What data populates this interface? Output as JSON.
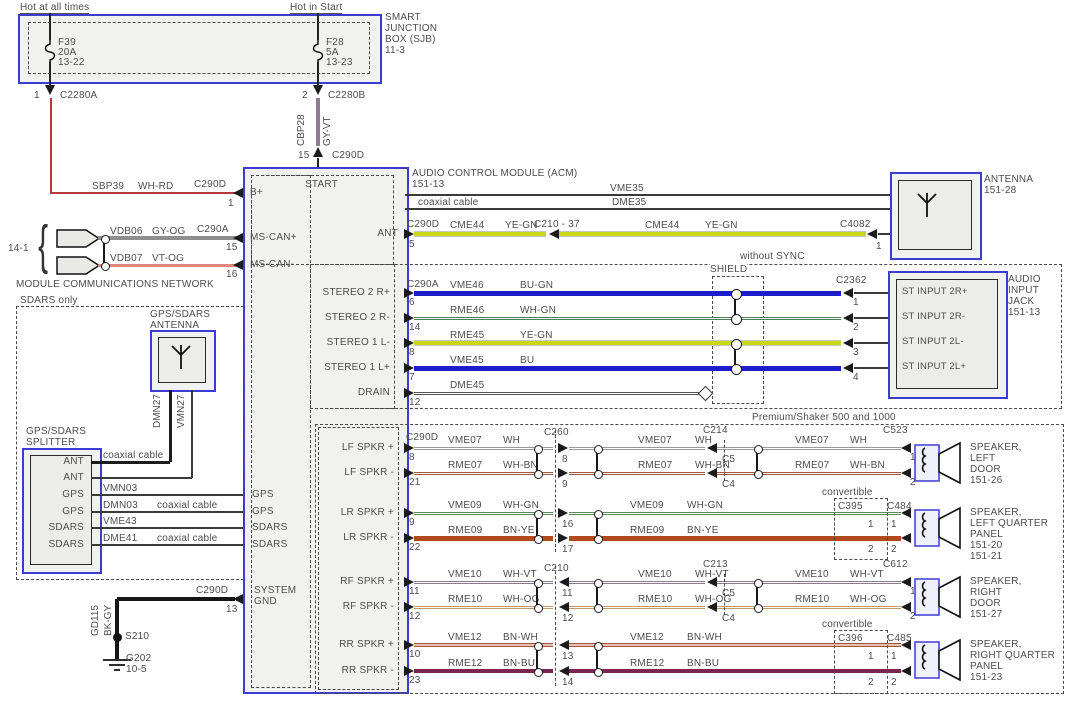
{
  "palette": {
    "box_blue": "#3c3cd0",
    "box_fill": "#f1f1ef",
    "text": "#4d4d4d",
    "wire_blue": "#1c1ecb",
    "wire_yegn": "#c9d816",
    "wire_whgn": "#4f7d55",
    "wire_wh": "#999999",
    "wire_whbn": "#a3543c",
    "wire_whgn2": "#5d8b5d",
    "wire_bnye": "#b2491c",
    "wire_whvt": "#8a7a92",
    "wire_whog": "#c09a6a",
    "wire_bnwh": "#a3543c",
    "wire_bnwh_center": "#e8c0b0",
    "wire_bnbu": "#7c2450",
    "wire_drain": "#555555",
    "wire_red": "#b93a3a",
    "wire_pink": "#e2857f",
    "wire_gyog": "#8f8f8f",
    "wire_gyvt": "#8d7b90",
    "wire_black": "#1c1c1c"
  },
  "power": {
    "hot_left": "Hot at all times",
    "hot_right": "Hot in Start",
    "sjb_lines": [
      "SMART",
      "JUNCTION",
      "BOX (SJB)",
      "11-3"
    ],
    "fuses": [
      {
        "name": "F39",
        "rating": "20A",
        "ref": "13-22",
        "pin": "1",
        "conn": "C2280A"
      },
      {
        "name": "F28",
        "rating": "5A",
        "ref": "13-23",
        "pin": "2",
        "conn": "C2280B"
      }
    ],
    "feed_right": {
      "circuit": "CBP28",
      "color": "GY-VT",
      "pin": "15",
      "conn": "C290D"
    },
    "bplus": {
      "circuit": "SBP39",
      "color": "WH-RD",
      "conn": "C290D",
      "pin": "1",
      "acm_label": "B+"
    }
  },
  "acm": {
    "title": "AUDIO CONTROL MODULE (ACM)",
    "ref": "151-13",
    "start": "START",
    "ant": "ANT",
    "system_gnd": [
      "SYSTEM",
      "GND"
    ],
    "gps_pins": [
      "GPS",
      "GPS",
      "SDARS",
      "SDARS"
    ]
  },
  "comms": {
    "bracket_ref": "14-1",
    "network_label": "MODULE COMMUNICATIONS NETWORK",
    "rows": [
      {
        "circuit": "VDB06",
        "color": "GY-OG",
        "conn": "C290A",
        "pin": "15",
        "acm_label": "MS-CAN+"
      },
      {
        "circuit": "VDB07",
        "color": "VT-OG",
        "conn": "",
        "pin": "16",
        "acm_label": "MS-CAN-"
      }
    ]
  },
  "sdars": {
    "section_label": "SDARS only",
    "antenna_label": [
      "GPS/SDARS",
      "ANTENNA"
    ],
    "splitter_label": [
      "GPS/SDARS",
      "SPLITTER"
    ],
    "antenna_circuits": [
      "DMN27",
      "VMN27"
    ],
    "splitter_pins": [
      "ANT",
      "ANT",
      "GPS",
      "GPS",
      "SDARS",
      "SDARS"
    ],
    "rows": [
      {
        "circuit": "",
        "note": "coaxial cable"
      },
      {
        "circuit": "",
        "note": ""
      },
      {
        "circuit": "VMN03",
        "note": ""
      },
      {
        "circuit": "DMN03",
        "note": "coaxial cable"
      },
      {
        "circuit": "VME43",
        "note": ""
      },
      {
        "circuit": "DME41",
        "note": "coaxial cable"
      }
    ]
  },
  "ground": {
    "circuit": "GD115",
    "color": "BK-GY",
    "splice": "S210",
    "ground": "G202",
    "ground_ref": "10-5",
    "conn": "C290D",
    "pin": "13"
  },
  "antenna_row": {
    "coax_circuits": [
      "VME35",
      "DME35"
    ],
    "coax_note": "coaxial cable",
    "acm_conn": "C290D",
    "acm_pin": "5",
    "circuit": "CME44",
    "color": "YE-GN",
    "mid_conn": "C210 - 37",
    "dest_conn": "C4082",
    "dest_pin": "1"
  },
  "antenna": {
    "label": [
      "ANTENNA",
      "151-28"
    ]
  },
  "sync": {
    "label": "without SYNC",
    "shield": "SHIELD",
    "jack_conn": "C2362",
    "jack_label": [
      "AUDIO",
      "INPUT",
      "JACK",
      "151-13"
    ],
    "rows": [
      {
        "acm_label": "STEREO 2 R+",
        "acm_conn": "C290A",
        "acm_pin": "6",
        "circuit": "VME46",
        "color": "BU-GN",
        "jack_pin": "1",
        "jack_label": "ST INPUT 2R+"
      },
      {
        "acm_label": "STEREO 2 R-",
        "acm_conn": "",
        "acm_pin": "14",
        "circuit": "RME46",
        "color": "WH-GN",
        "jack_pin": "2",
        "jack_label": "ST INPUT 2R-"
      },
      {
        "acm_label": "STEREO 1 L-",
        "acm_conn": "",
        "acm_pin": "8",
        "circuit": "RME45",
        "color": "YE-GN",
        "jack_pin": "3",
        "jack_label": "ST INPUT 2L-"
      },
      {
        "acm_label": "STEREO 1 L+",
        "acm_conn": "",
        "acm_pin": "7",
        "circuit": "VME45",
        "color": "BU",
        "jack_pin": "4",
        "jack_label": "ST INPUT 2L+"
      },
      {
        "acm_label": "DRAIN",
        "acm_conn": "",
        "acm_pin": "12",
        "circuit": "DME45",
        "color": "",
        "jack_pin": "",
        "jack_label": ""
      }
    ]
  },
  "premium": {
    "label": "Premium/Shaker 500 and 1000",
    "convertible": "convertible",
    "groups": [
      {
        "mid1": "C260",
        "mid2": "C214",
        "dest": "C523",
        "acm_conn": "C290D",
        "rows": [
          {
            "acm_label": "LF SPKR +",
            "acm_pin": "8",
            "circuit": "VME07",
            "color": "WH",
            "mid1_pin": "8",
            "mid2_pin": "C5",
            "dest_pin": "1"
          },
          {
            "acm_label": "LF SPKR -",
            "acm_pin": "21",
            "circuit": "RME07",
            "color": "WH-BN",
            "mid1_pin": "9",
            "mid2_pin": "C4",
            "dest_pin": "2"
          }
        ],
        "speaker": [
          "SPEAKER,",
          "LEFT",
          "DOOR",
          "151-26"
        ]
      },
      {
        "conv": "C395",
        "dest": "C484",
        "rows": [
          {
            "acm_label": "LR SPKR +",
            "acm_pin": "9",
            "circuit": "VME09",
            "color": "WH-GN",
            "mid1_pin": "16",
            "conv_pin": "1",
            "dest_pin": "1"
          },
          {
            "acm_label": "LR SPKR -",
            "acm_pin": "22",
            "circuit": "RME09",
            "color": "BN-YE",
            "mid1_pin": "17",
            "conv_pin": "2",
            "dest_pin": "2"
          }
        ],
        "speaker": [
          "SPEAKER,",
          "LEFT QUARTER",
          "PANEL",
          "151-20",
          "151-21"
        ]
      },
      {
        "mid1": "C210",
        "mid2": "C213",
        "dest": "C612",
        "rows": [
          {
            "acm_label": "RF SPKR +",
            "acm_pin": "11",
            "circuit": "VME10",
            "color": "WH-VT",
            "mid1_pin": "11",
            "mid2_pin": "C5",
            "dest_pin": "1"
          },
          {
            "acm_label": "RF SPKR -",
            "acm_pin": "12",
            "circuit": "RME10",
            "color": "WH-OG",
            "mid1_pin": "12",
            "mid2_pin": "C4",
            "dest_pin": "2"
          }
        ],
        "speaker": [
          "SPEAKER,",
          "RIGHT",
          "DOOR",
          "151-27"
        ]
      },
      {
        "conv": "C396",
        "dest": "C485",
        "rows": [
          {
            "acm_label": "RR SPKR +",
            "acm_pin": "10",
            "circuit": "VME12",
            "color": "BN-WH",
            "mid1_pin": "13",
            "conv_pin": "1",
            "dest_pin": "1"
          },
          {
            "acm_label": "RR SPKR -",
            "acm_pin": "23",
            "circuit": "RME12",
            "color": "BN-BU",
            "mid1_pin": "14",
            "conv_pin": "2",
            "dest_pin": "2"
          }
        ],
        "speaker": [
          "SPEAKER,",
          "RIGHT QUARTER",
          "PANEL",
          "151-23"
        ]
      }
    ]
  }
}
